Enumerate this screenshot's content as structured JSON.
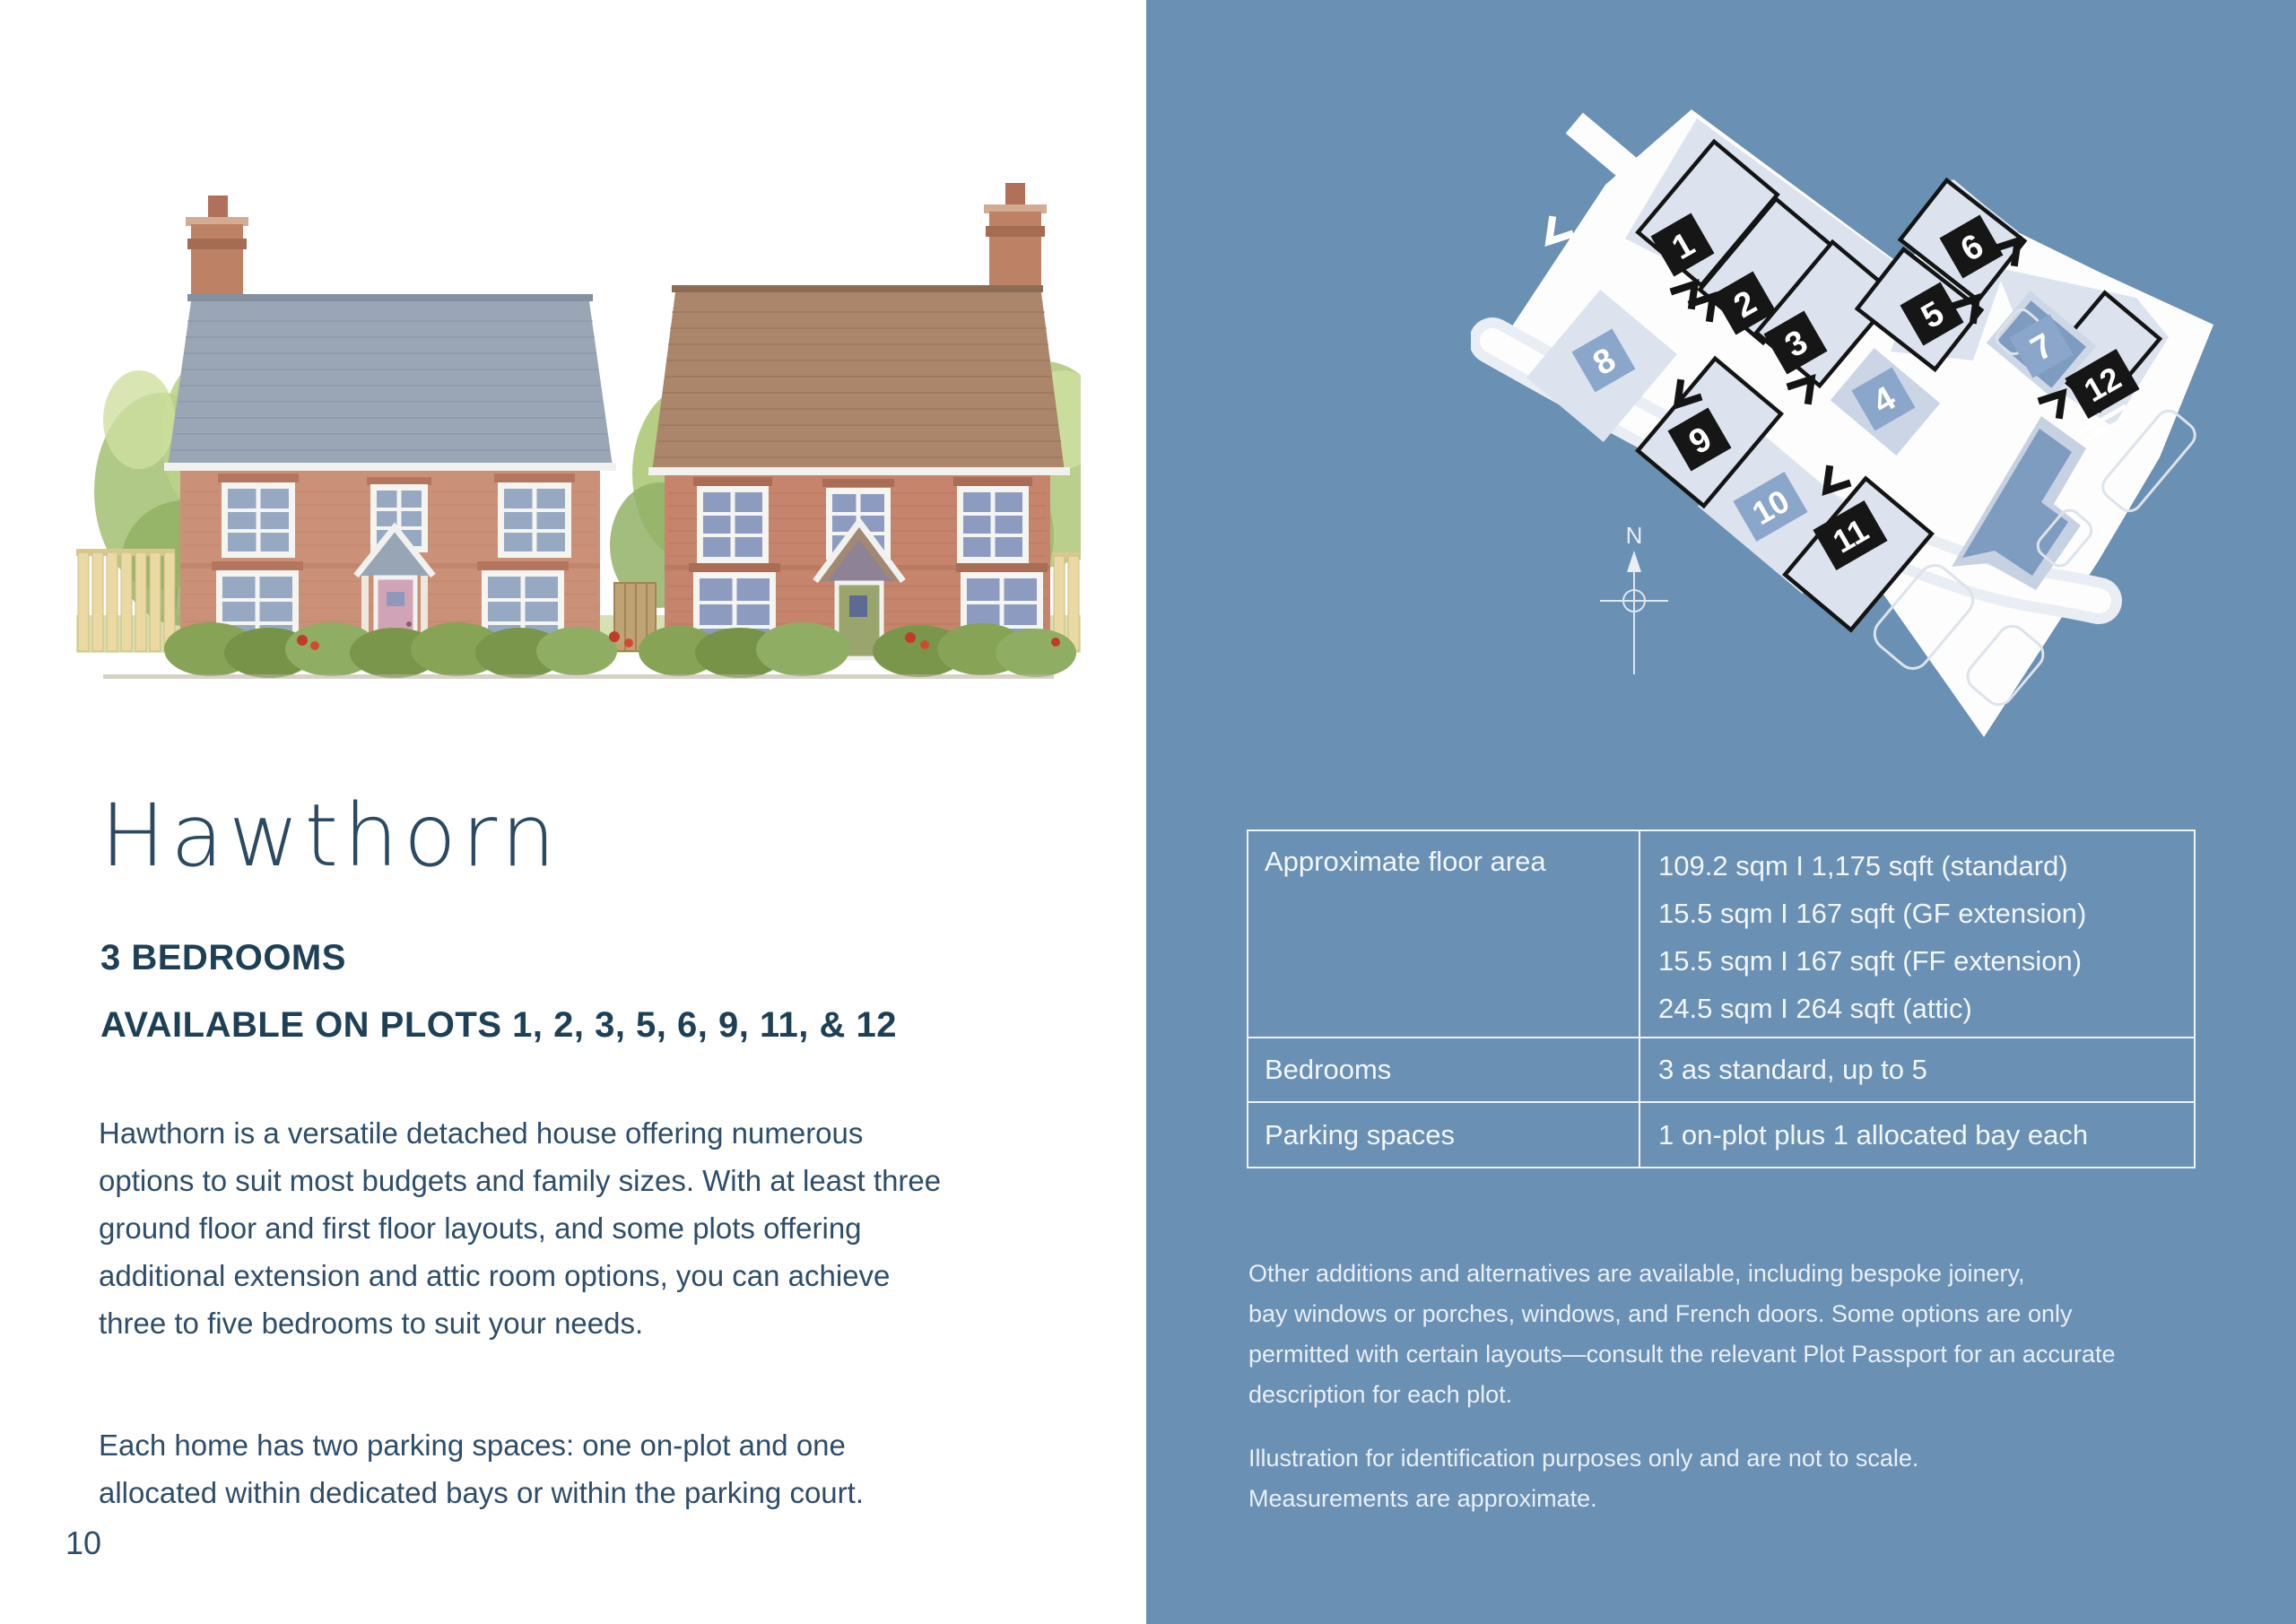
{
  "colors": {
    "panel_blue": "#6a90b4",
    "dark_navy_heading": "#1e4057",
    "body_text": "#2e4d6b",
    "table_text_white": "#f2f6fa",
    "parcel_fill": "#dce3ef",
    "plot_tag_black": "#161616",
    "plot_tag_blue": "#8ba6cb",
    "building_blue": "#7e9cc0"
  },
  "left_page": {
    "title": "Hawthorn",
    "bedrooms_heading": "3 BEDROOMS",
    "availability_heading": "AVAILABLE ON PLOTS 1, 2, 3, 5, 6, 9, 11, & 12",
    "paragraph1_lines": [
      "Hawthorn is a versatile detached house offering numerous",
      "options to suit most budgets and family sizes. With at least three",
      "ground floor and first floor layouts, and some plots offering",
      "additional extension and attic room options, you can achieve",
      "three to five bedrooms to suit your needs."
    ],
    "paragraph2_lines": [
      "Each home has two parking spaces: one on-plot and one",
      "allocated within dedicated bays or within the parking court."
    ],
    "page_number": "10"
  },
  "spec_table": {
    "rows": [
      {
        "label": "Approximate floor area",
        "values": [
          "109.2 sqm  I  1,175 sqft (standard)",
          "15.5 sqm  I  167 sqft (GF extension)",
          "15.5 sqm  I  167 sqft (FF extension)",
          "24.5 sqm  I  264 sqft (attic)"
        ]
      },
      {
        "label": "Bedrooms",
        "values": [
          "3 as standard, up to 5"
        ]
      },
      {
        "label": "Parking spaces",
        "values": [
          "1 on-plot plus 1 allocated bay each"
        ]
      }
    ]
  },
  "notes": {
    "options_lines": [
      "Other additions and alternatives are available, including bespoke joinery,",
      "bay windows or porches, windows, and French doors. Some options are only",
      "permitted with certain layouts—consult the relevant Plot Passport for an accurate",
      "description for each plot."
    ],
    "disclaimer_lines": [
      "Illustration for identification purposes only and are not to scale.",
      "Measurements are approximate."
    ]
  },
  "site_plan": {
    "north_label": "N",
    "plots": {
      "p1": "1",
      "p2": "2",
      "p3": "3",
      "p4": "4",
      "p5": "5",
      "p6": "6",
      "p7": "7",
      "p8": "8",
      "p9": "9",
      "p10": "10",
      "p11": "11",
      "p12": "12"
    },
    "available_plot_numbers": [
      "1",
      "2",
      "3",
      "5",
      "6",
      "9",
      "11",
      "12"
    ],
    "other_plot_numbers": [
      "4",
      "7",
      "8",
      "10"
    ]
  }
}
